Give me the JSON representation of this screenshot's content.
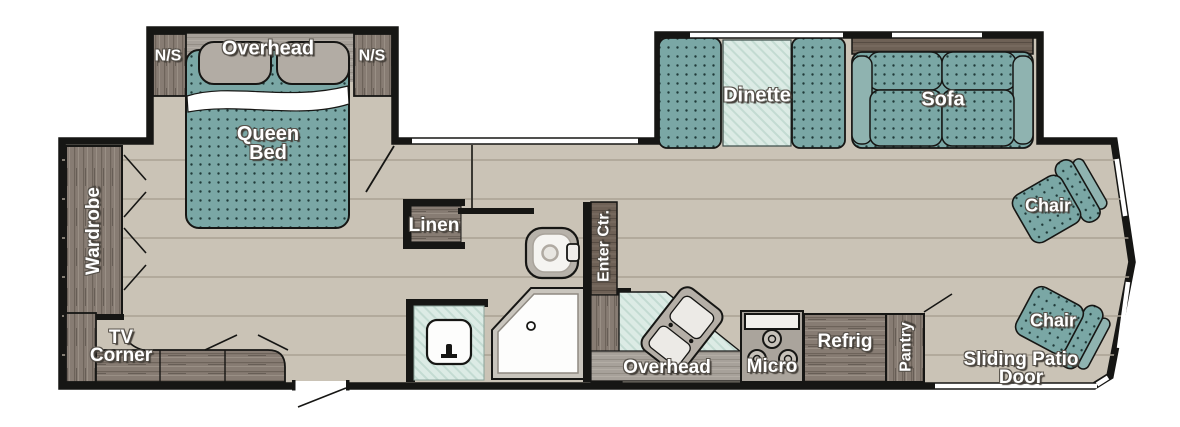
{
  "plan": {
    "type": "rv-travel-trailer-floorplan",
    "colors": {
      "floor": "#cac3b6",
      "plank_line": "#a9a193",
      "wall": "#161614",
      "upholstery_teal": "#7aa7a5",
      "upholstery_dot": "#1f3a39",
      "counter_mint": "#dcebe5",
      "wood_cabinet": "#877c73",
      "wood_dark": "#6e6156",
      "fixture_gray": "#a7a19a",
      "label_text": "#ffffff"
    },
    "fixtures": [
      "queen-bed",
      "pillows",
      "overhead-cabinet",
      "nightstand-left",
      "nightstand-right",
      "wardrobe",
      "tv-corner-cabinet",
      "linen-closet",
      "toilet",
      "shower",
      "vanity-sink",
      "entertainment-center",
      "kitchen-counter",
      "kitchen-sink",
      "range-microwave",
      "refrigerator",
      "pantry",
      "dinette-booth",
      "dinette-table",
      "sofa",
      "armchair-top",
      "armchair-bottom",
      "entry-door",
      "sliding-patio-door",
      "slide-out-windows"
    ]
  },
  "labels": {
    "ns_left": "N/S",
    "overhead_bed": "Overhead",
    "ns_right": "N/S",
    "queen_bed": "Queen\nBed",
    "wardrobe": "Wardrobe",
    "tv_corner": "TV\nCorner",
    "linen": "Linen",
    "enter_ctr": "Enter Ctr.",
    "dinette": "Dinette",
    "sofa": "Sofa",
    "chair_top": "Chair",
    "chair_bottom": "Chair",
    "overhead_kitchen": "Overhead",
    "micro": "Micro",
    "refrig": "Refrig",
    "pantry": "Pantry",
    "sliding_patio_door": "Sliding Patio Door"
  }
}
